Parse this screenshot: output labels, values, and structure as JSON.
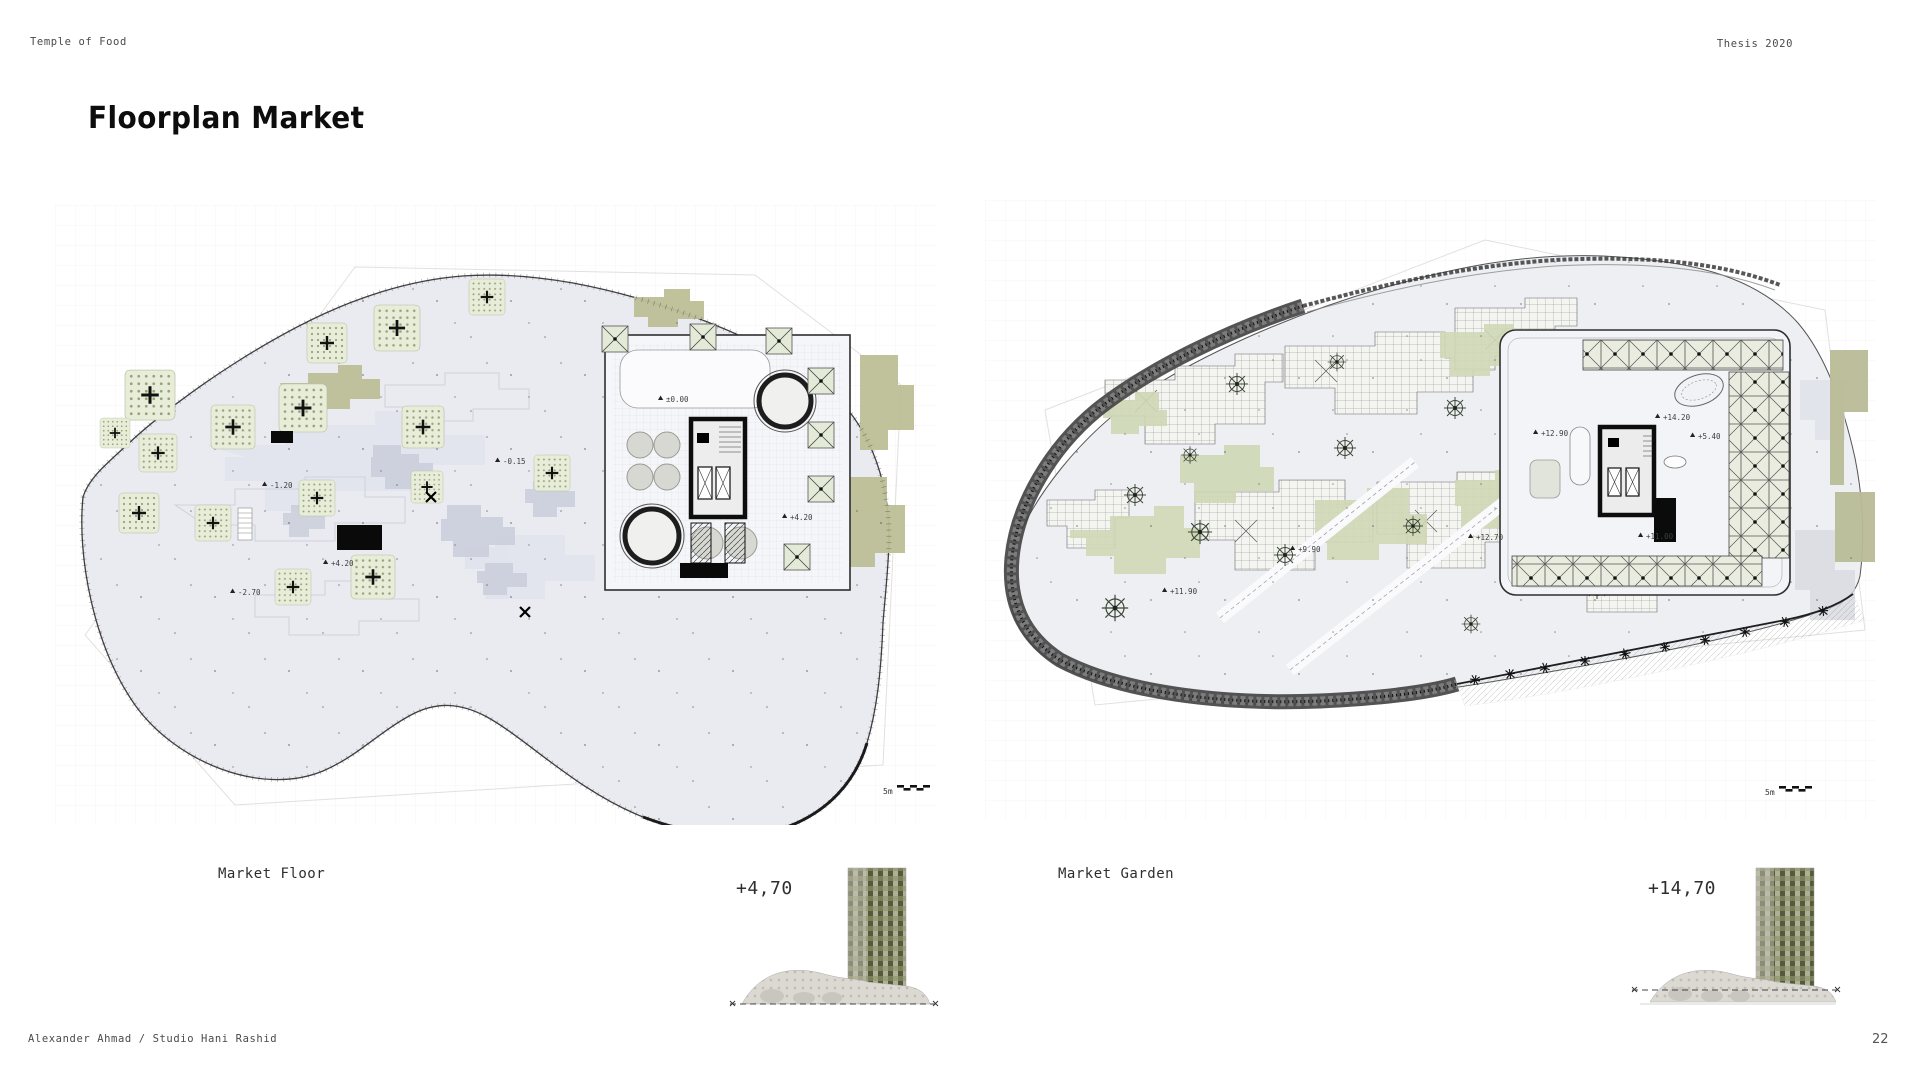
{
  "header": {
    "project": "Temple of Food",
    "year": "Thesis 2020"
  },
  "title": {
    "text": "Floorplan Market"
  },
  "footer": {
    "credit": "Alexander Ahmad / Studio Hani Rashid",
    "page": "22"
  },
  "plans": {
    "left": {
      "caption": "Market Floor",
      "elevation": "+4,70",
      "scale_label": "5m",
      "annotations": [
        {
          "label": "±0.00"
        },
        {
          "label": "-0.15"
        },
        {
          "label": "-1.20"
        },
        {
          "label": "+4.20"
        },
        {
          "label": "-2.70"
        },
        {
          "label": "+4.20"
        }
      ]
    },
    "right": {
      "caption": "Market Garden",
      "elevation": "+14,70",
      "scale_label": "5m",
      "annotations": [
        {
          "label": "+12.90"
        },
        {
          "label": "+14.20"
        },
        {
          "label": "+5.40"
        },
        {
          "label": "+11.00"
        },
        {
          "label": "+12.70"
        },
        {
          "label": "+9.90"
        },
        {
          "label": "+11.90"
        }
      ]
    }
  }
}
